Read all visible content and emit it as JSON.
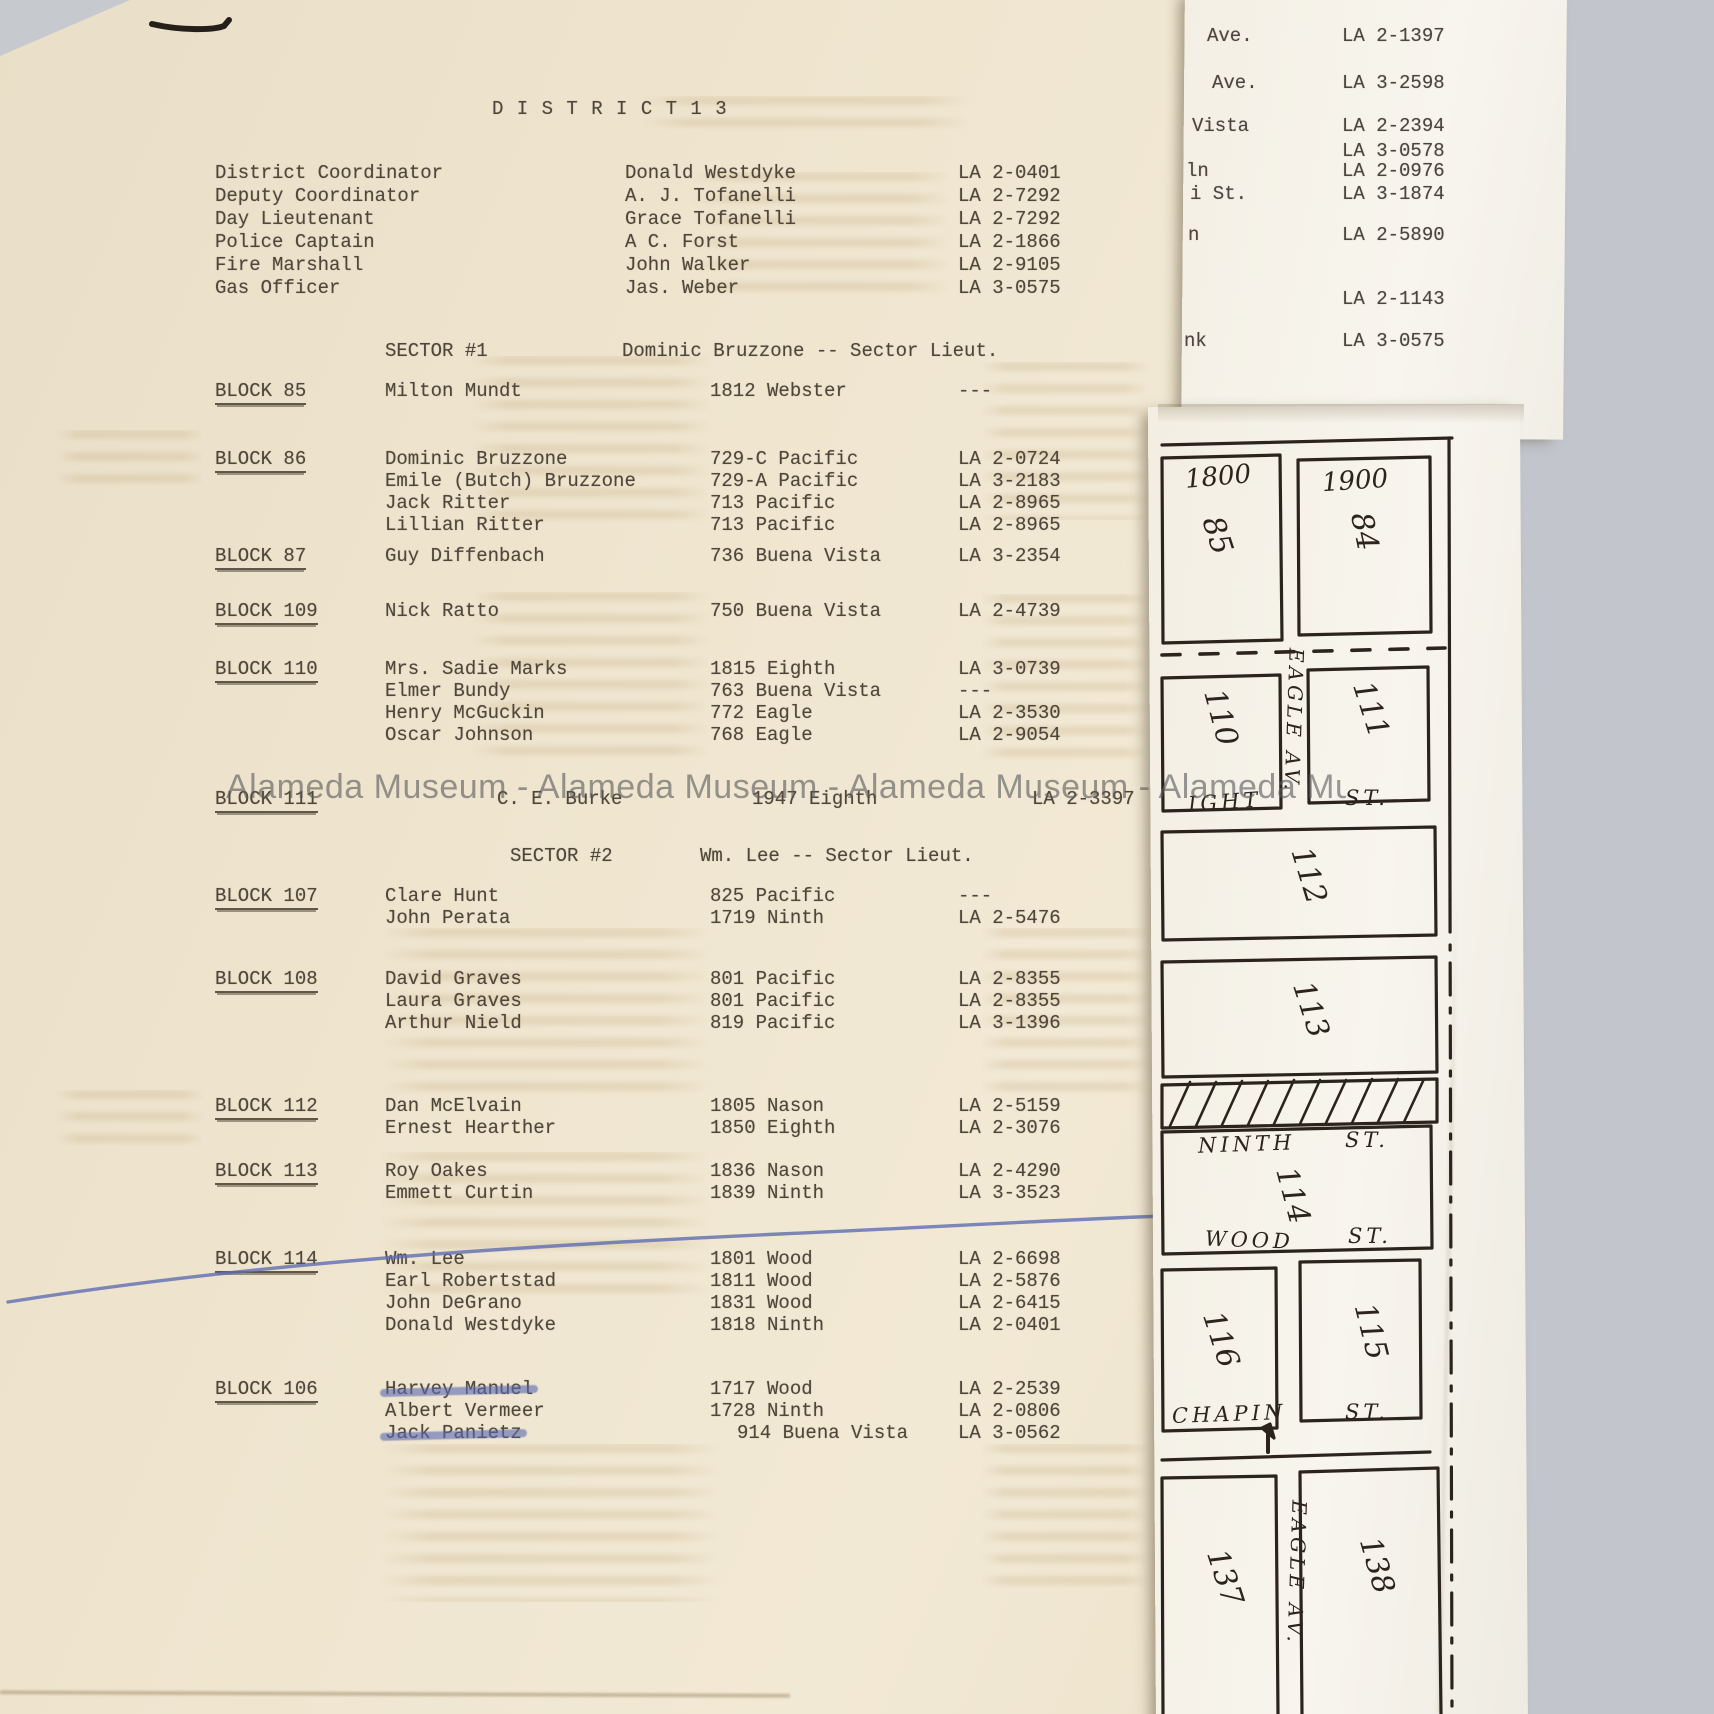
{
  "colors": {
    "background": "#c2c5cb",
    "paper_cream": "#efe5cf",
    "paper_white": "#f7f4ec",
    "typewriter_ink": "#4f4639",
    "map_ink": "#2b241d",
    "pen_blue": "#5e6db0",
    "watermark_gray": "#5a5a5c"
  },
  "watermark": {
    "text": "Alameda Museum - Alameda Museum - Alameda Museum - Alameda Museum"
  },
  "page": {
    "title": "D I S T R I C T   1 3",
    "officials": [
      {
        "label": "District Coordinator",
        "name": "Donald Westdyke",
        "phone": "LA 2-0401"
      },
      {
        "label": "Deputy Coordinator",
        "name": "A. J. Tofanelli",
        "phone": "LA 2-7292"
      },
      {
        "label": "Day Lieutenant",
        "name": "Grace Tofanelli",
        "phone": "LA 2-7292"
      },
      {
        "label": "Police Captain",
        "name": "A C. Forst",
        "phone": "LA 2-1866"
      },
      {
        "label": "Fire Marshall",
        "name": "John Walker",
        "phone": "LA 2-9105"
      },
      {
        "label": "Gas Officer",
        "name": "Jas. Weber",
        "phone": "LA 3-0575"
      }
    ],
    "sectors": [
      {
        "heading": "SECTOR #1",
        "lieutenant": "Dominic Bruzzone  --  Sector Lieut.",
        "blocks": [
          {
            "label": "BLOCK 85",
            "members": [
              {
                "name": "Milton Mundt",
                "address": "1812 Webster",
                "phone": "---"
              }
            ]
          },
          {
            "label": "BLOCK 86",
            "members": [
              {
                "name": "Dominic Bruzzone",
                "address": "729-C Pacific",
                "phone": "LA 2-0724"
              },
              {
                "name": "Emile (Butch) Bruzzone",
                "address": "729-A Pacific",
                "phone": "LA 3-2183"
              },
              {
                "name": "Jack Ritter",
                "address": "713 Pacific",
                "phone": "LA 2-8965"
              },
              {
                "name": "Lillian Ritter",
                "address": "713 Pacific",
                "phone": "LA 2-8965"
              }
            ]
          },
          {
            "label": "BLOCK 87",
            "members": [
              {
                "name": "Guy Diffenbach",
                "address": "736 Buena Vista",
                "phone": "LA 3-2354"
              }
            ]
          },
          {
            "label": "BLOCK 109",
            "members": [
              {
                "name": "Nick Ratto",
                "address": "750 Buena Vista",
                "phone": "LA 2-4739"
              }
            ]
          },
          {
            "label": "BLOCK 110",
            "members": [
              {
                "name": "Mrs. Sadie Marks",
                "address": "1815 Eighth",
                "phone": "LA 3-0739"
              },
              {
                "name": "Elmer Bundy",
                "address": "763 Buena Vista",
                "phone": "---"
              },
              {
                "name": "Henry McGuckin",
                "address": "772 Eagle",
                "phone": "LA 2-3530"
              },
              {
                "name": "Oscar Johnson",
                "address": "768 Eagle",
                "phone": "LA 2-9054"
              }
            ]
          },
          {
            "label": "BLOCK 111",
            "members": [
              {
                "name": "C. E. Burke",
                "address": "1947 Eighth",
                "phone": "LA 2-3397"
              }
            ]
          }
        ]
      },
      {
        "heading": "SECTOR #2",
        "lieutenant": "Wm. Lee  --  Sector Lieut.",
        "blocks": [
          {
            "label": "BLOCK 107",
            "members": [
              {
                "name": "Clare Hunt",
                "address": "825 Pacific",
                "phone": "---"
              },
              {
                "name": "John Perata",
                "address": "1719 Ninth",
                "phone": "LA 2-5476"
              }
            ]
          },
          {
            "label": "BLOCK 108",
            "members": [
              {
                "name": "David Graves",
                "address": "801 Pacific",
                "phone": "LA 2-8355"
              },
              {
                "name": "Laura Graves",
                "address": "801 Pacific",
                "phone": "LA 2-8355"
              },
              {
                "name": "Arthur Nield",
                "address": "819 Pacific",
                "phone": "LA 3-1396"
              }
            ]
          },
          {
            "label": "BLOCK 112",
            "members": [
              {
                "name": "Dan McElvain",
                "address": "1805 Nason",
                "phone": "LA 2-5159"
              },
              {
                "name": "Ernest Hearther",
                "address": "1850 Eighth",
                "phone": "LA 2-3076"
              }
            ]
          },
          {
            "label": "BLOCK 113",
            "members": [
              {
                "name": "Roy Oakes",
                "address": "1836 Nason",
                "phone": "LA 2-4290"
              },
              {
                "name": "Emmett Curtin",
                "address": "1839 Ninth",
                "phone": "LA 3-3523"
              }
            ]
          },
          {
            "label": "BLOCK 114",
            "members": [
              {
                "name": "Wm. Lee",
                "address": "1801 Wood",
                "phone": "LA 2-6698"
              },
              {
                "name": "Earl Robertstad",
                "address": "1811 Wood",
                "phone": "LA 2-5876"
              },
              {
                "name": "John DeGrano",
                "address": "1831 Wood",
                "phone": "LA 2-6415"
              },
              {
                "name": "Donald Westdyke",
                "address": "1818 Ninth",
                "phone": "LA 2-0401"
              }
            ]
          },
          {
            "label": "BLOCK 106",
            "members": [
              {
                "name": "Harvey Manuel",
                "address": "1717 Wood",
                "phone": "LA 2-2539"
              },
              {
                "name": "Albert Vermeer",
                "address": "1728 Ninth",
                "phone": "LA 2-0806"
              },
              {
                "name": "Jack Panietz",
                "address": "914 Buena Vista",
                "phone": "LA 3-0562"
              }
            ]
          }
        ]
      }
    ]
  },
  "side_sheet": {
    "rows": [
      {
        "label": "Ave.",
        "phone": "LA 2-1397"
      },
      {
        "label": "Ave.",
        "phone": "LA 3-2598"
      },
      {
        "label": "Vista",
        "phone": "LA 2-2394"
      },
      {
        "label": "",
        "phone": "LA 3-0578"
      },
      {
        "label": "ln",
        "phone": "LA 2-0976"
      },
      {
        "label": "i St.",
        "phone": "LA 3-1874"
      },
      {
        "label": "n",
        "phone": "LA 2-5890"
      },
      {
        "label": "",
        "phone": "LA 2-1143"
      },
      {
        "label": "nk",
        "phone": "LA 3-0575"
      }
    ]
  },
  "map": {
    "house_numbers": [
      "1800",
      "1900"
    ],
    "block_numbers": [
      "85",
      "84",
      "110",
      "111",
      "112",
      "113",
      "114",
      "116",
      "115",
      "137",
      "138"
    ],
    "streets": {
      "eagle_upper": "EAGLE AV.",
      "eighth_partial": "IGHT",
      "ninth": "NINTH",
      "wood": "WOOD",
      "chapin": "CHAPIN",
      "st": "ST.",
      "eagle_lower": "EAGLE AV."
    }
  }
}
